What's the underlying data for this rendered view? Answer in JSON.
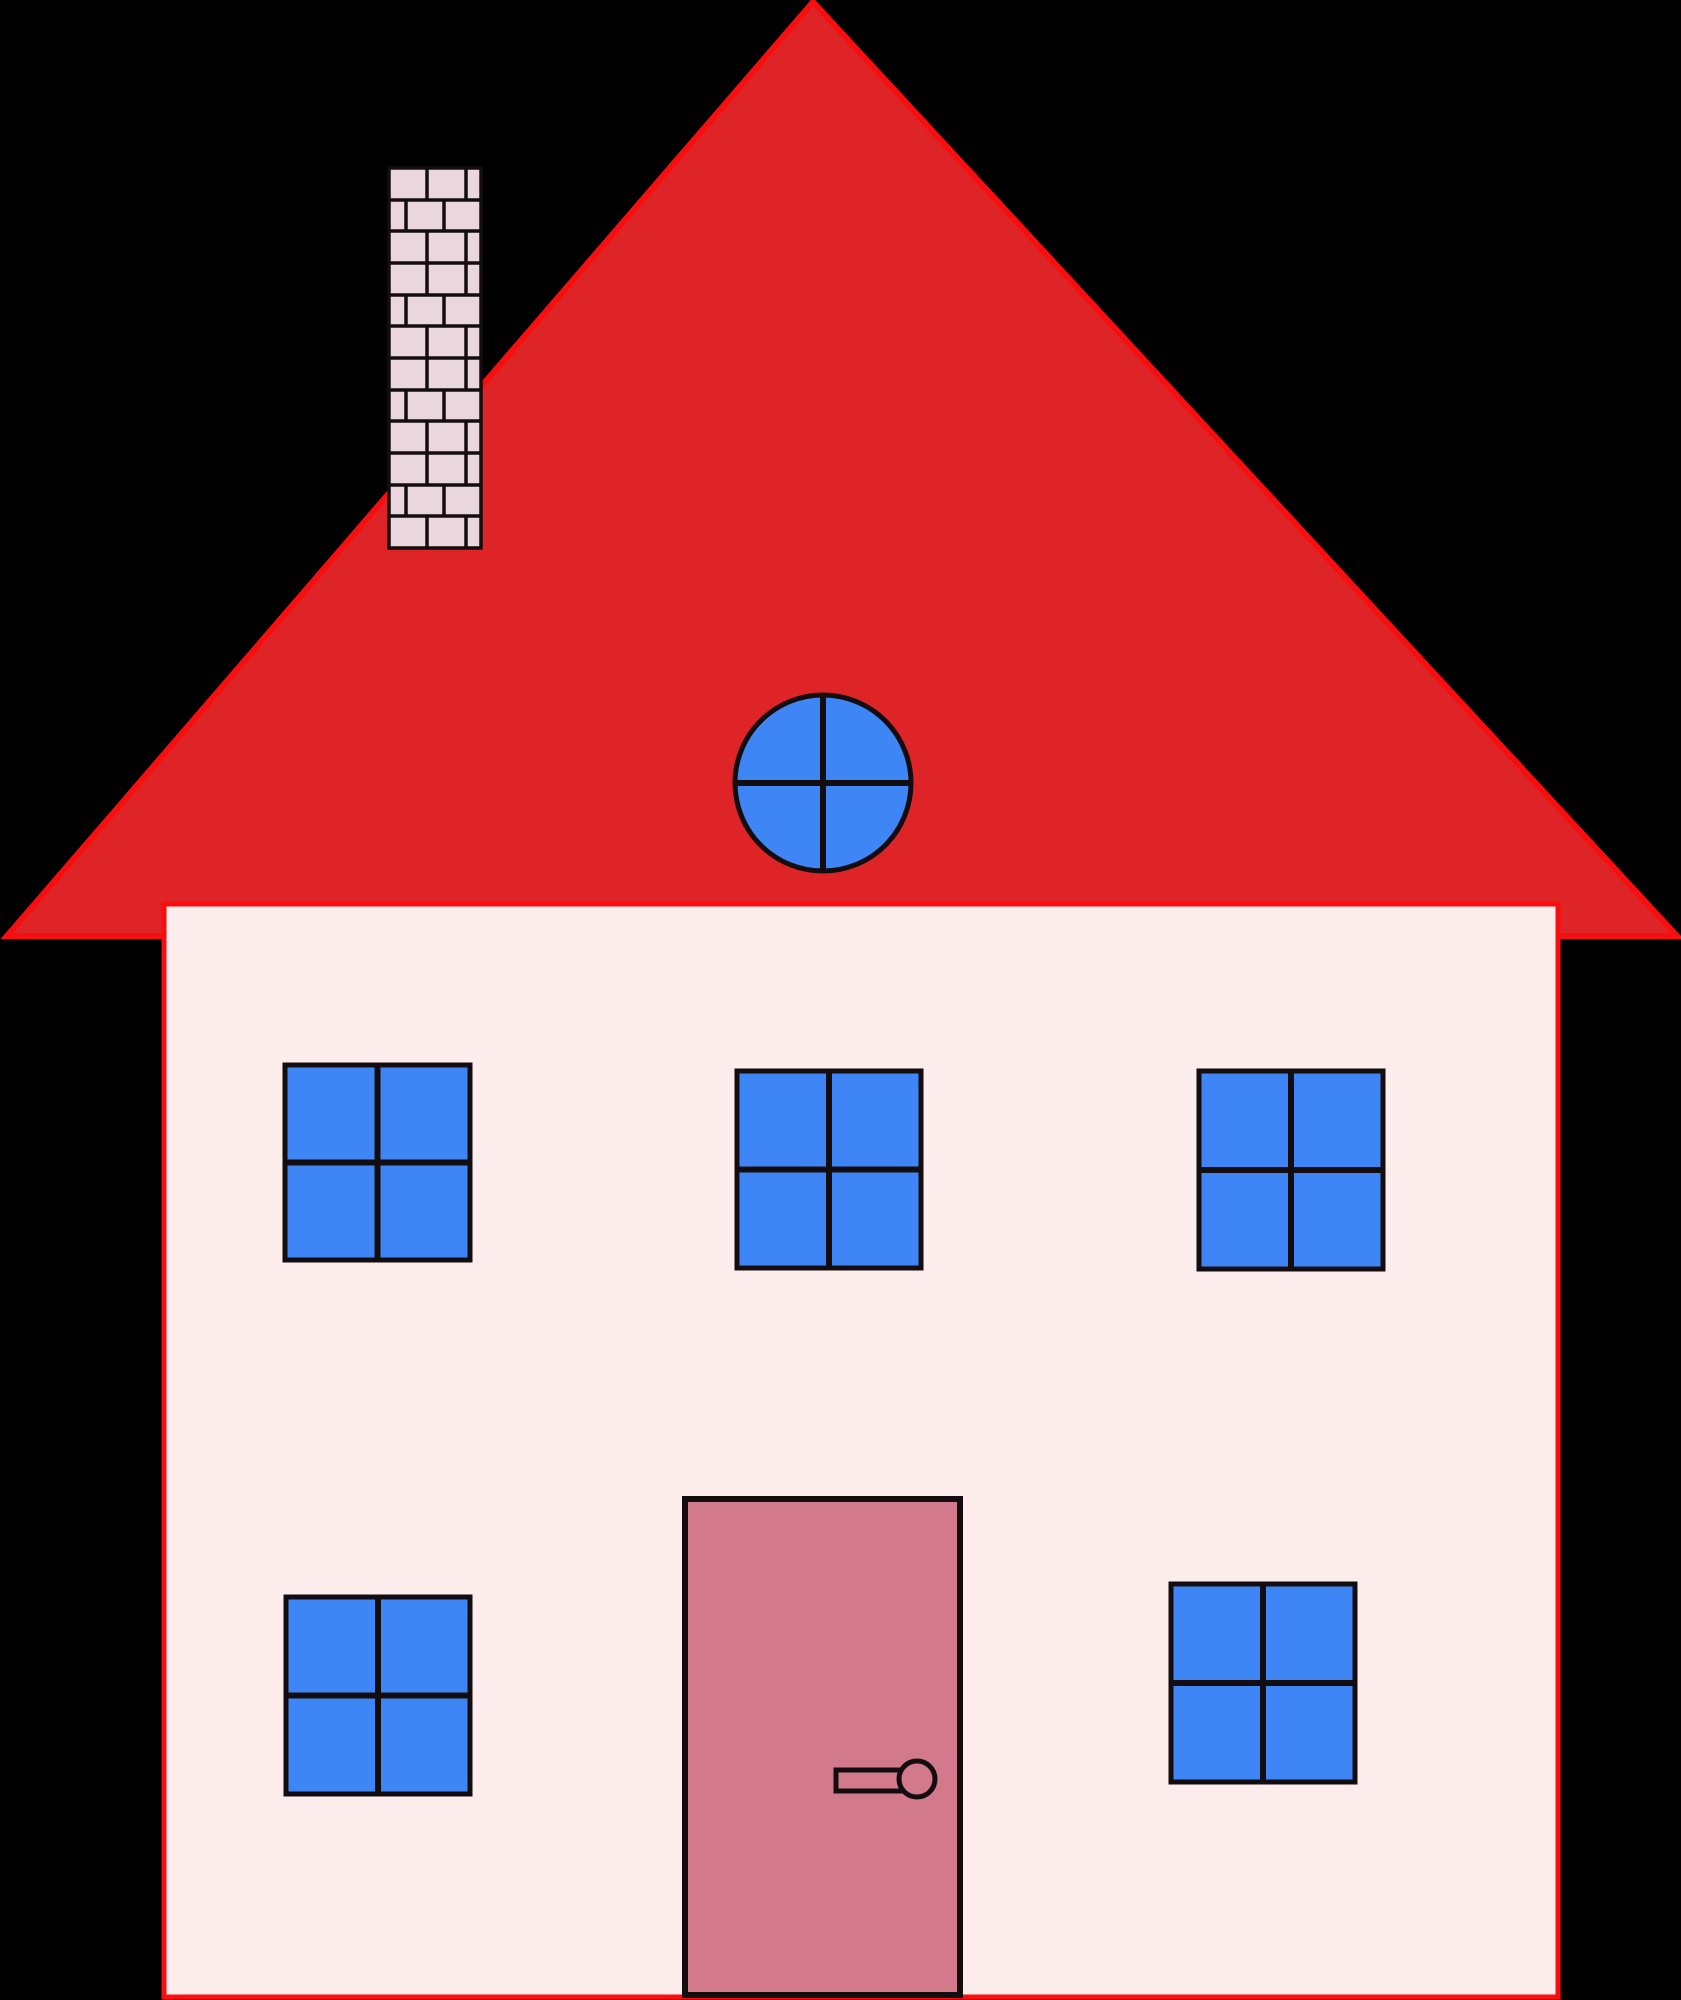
{
  "scene": {
    "title": "house-illustration",
    "background": "#000000",
    "colors": {
      "roof": "#de2427",
      "roof-edge": "#f70f0f",
      "wall": "#fdecec",
      "wall-edge": "#f70f0f",
      "window-blue": "#3e86f5",
      "door-pink": "#d2798c",
      "brick-pink": "#ead7dd",
      "outline": "#140d0f",
      "background": "#000000"
    },
    "counts": {
      "square_windows": 5,
      "round_windows": 1,
      "doors": 1,
      "door_handles": 1,
      "chimneys": 1,
      "brick_rows": 12
    }
  }
}
